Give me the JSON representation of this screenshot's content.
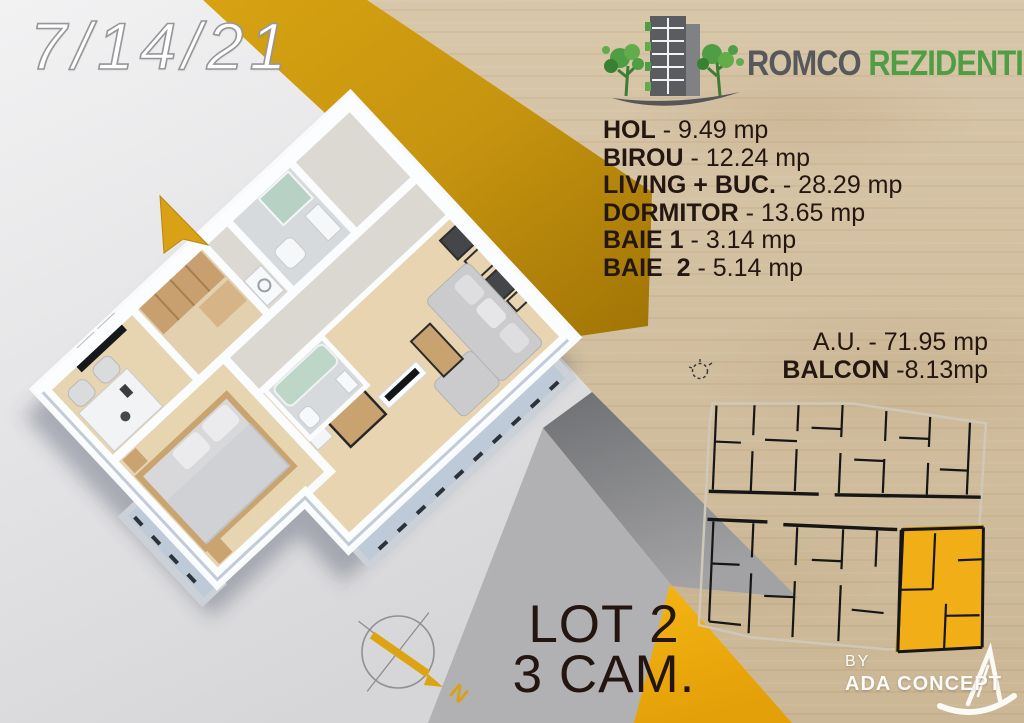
{
  "date_stamp": "7/14/21",
  "brand": {
    "primary": "ROMCO",
    "secondary": "REZIDENTIAL"
  },
  "rooms": [
    {
      "label": "HOL",
      "value": "- 9.49 mp"
    },
    {
      "label": "BIROU",
      "value": "- 12.24 mp"
    },
    {
      "label": "LIVING + BUC.",
      "value": "- 28.29 mp"
    },
    {
      "label": "DORMITOR",
      "value": "- 13.65 mp"
    },
    {
      "label": "BAIE 1",
      "value": "- 3.14 mp"
    },
    {
      "label": "BAIE  2",
      "value": "- 5.14 mp"
    }
  ],
  "summary": {
    "au_label": "A.U.",
    "au_value": "- 71.95 mp",
    "balcon_label": "BALCON",
    "balcon_value": "-8.13mp"
  },
  "lot": {
    "line1": "LOT 2",
    "line2": "3 CAM."
  },
  "credit": {
    "by": "BY",
    "name": "ADA CONCEPT"
  },
  "compass": {
    "north": "N"
  },
  "colors": {
    "accent_gold": "#d9a013",
    "brand_green": "#4f9e45",
    "brand_gray": "#57585c",
    "wood_base": "#d5c2a4",
    "unit_highlight": "#f2ae17",
    "text_dark": "#241711"
  }
}
